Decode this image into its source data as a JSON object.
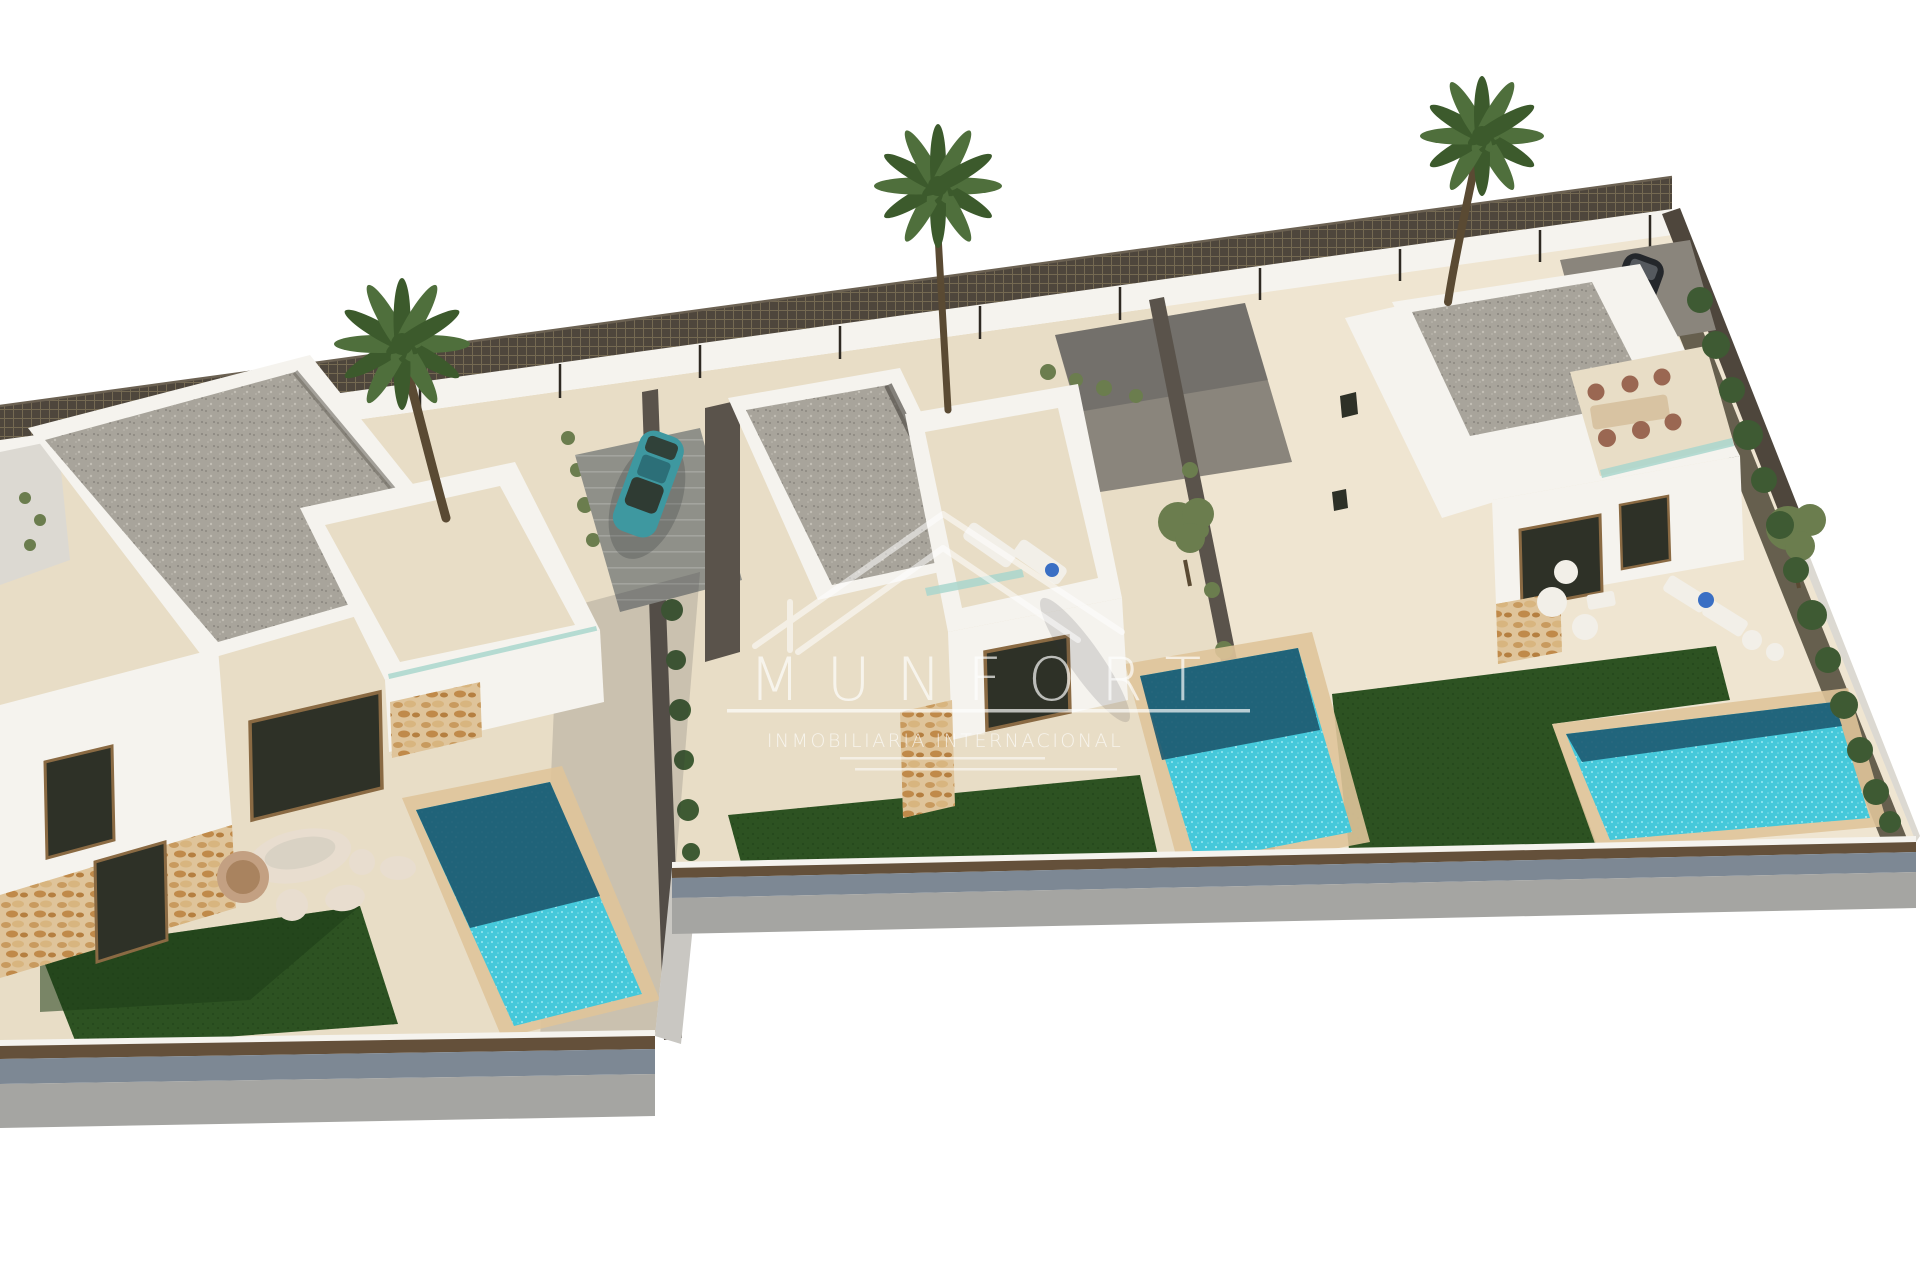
{
  "page": {
    "width": 1920,
    "height": 1280,
    "background": "#ffffff"
  },
  "watermark": {
    "brand": "MUNFORT",
    "tagline": "INMOBILIARIA INTERNACIONAL",
    "logo": "double-roof-outline-icon"
  },
  "scene": {
    "description": "Aerial 3D architectural render of three modern white villas, each with a private turquoise pool, artificial lawn and terrace; palm trees, mesh perimeter fence, one teal car and one dark car",
    "villa_count": 3,
    "pool_count": 3,
    "palm_tree_count": 3,
    "car_count": 2,
    "lawn_count": 3
  },
  "palette": {
    "bg": "#ffffff",
    "sand": "#e8ddc6",
    "sandBright": "#efe5d1",
    "pathGrey": "#8f9089",
    "padGrey": "#8a857c",
    "gravel": "#a8a49b",
    "wallWhite": "#f5f3ee",
    "wallShade": "#dcd9d2",
    "sideDark": "#5a534b",
    "stone": "#dfc49a",
    "windowDark": "#2e3127",
    "frameTan": "#8a6a43",
    "poolBright": "#45c8da",
    "poolShadow": "#1d5a71",
    "lawn": "#2d5222",
    "lawnDark": "#1e3c17",
    "hedge": "#3e5a33",
    "treeOlive": "#6b7d4e",
    "mesh": "#4e463c",
    "meshLine": "#8d8060",
    "fenceBrown": "#64503a",
    "wallBlue": "#7d8894",
    "wallGrey": "#a5a5a2",
    "stepGrey": "#c9c7c2",
    "carTeal": "#3e98a0",
    "carTealDark": "#2c6f78",
    "carDark": "#24272b",
    "carRoofGrey": "#858c92",
    "glass": "#a9d6cc",
    "towel": "#3a6fc4",
    "shadow": "#2f3338",
    "trunk": "#5a4a33",
    "palm": "#4f6f3c",
    "palmDark": "#3c5a2c",
    "beanbag": "#e8ddcf",
    "beanbagTan": "#c3a082",
    "furnWhite": "#f2efe8",
    "tableTan": "#d8c3a2",
    "chairBrown": "#9a6752",
    "wm": "#ffffff"
  }
}
